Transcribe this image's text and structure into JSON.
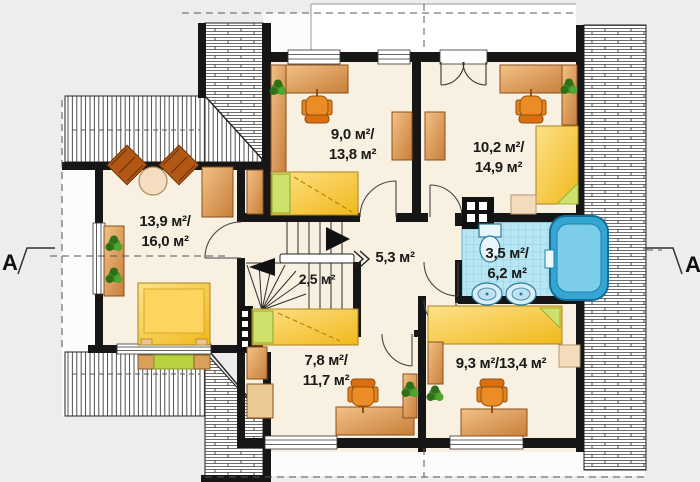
{
  "title": "Attic floor plan",
  "section_markers": {
    "left": "A",
    "right": "A"
  },
  "rooms": {
    "left_bedroom": {
      "area_lines": [
        "13,9 м²/",
        "16,0 м²"
      ]
    },
    "top_middle_bedroom": {
      "area_lines": [
        "9,0 м²/",
        "13,8 м²"
      ]
    },
    "top_right_bedroom": {
      "area_lines": [
        "10,2 м²/",
        "14,9 м²"
      ]
    },
    "hall": {
      "area_lines": [
        "5,3 м²"
      ]
    },
    "staircase": {
      "area_lines": [
        "2,5 м²"
      ]
    },
    "bathroom": {
      "area_lines": [
        "3,5 м²/",
        "6,2 м²"
      ]
    },
    "bottom_middle_bedroom": {
      "area_lines": [
        "7,8 м²/",
        "11,7 м²"
      ]
    },
    "bottom_right_bedroom": {
      "area_lines": [
        "9,3 м²/13,4 м²"
      ]
    }
  },
  "colors": {
    "background": "#ededed",
    "wall": "#161616",
    "floor": "#f8f1e2",
    "furniture_wood": "#d28c46",
    "bed_yellow": "#f5c02c",
    "accent_green": "#b7d23e",
    "bath_tile": "#b9e6f3",
    "tub_blue": "#35a5d4"
  }
}
